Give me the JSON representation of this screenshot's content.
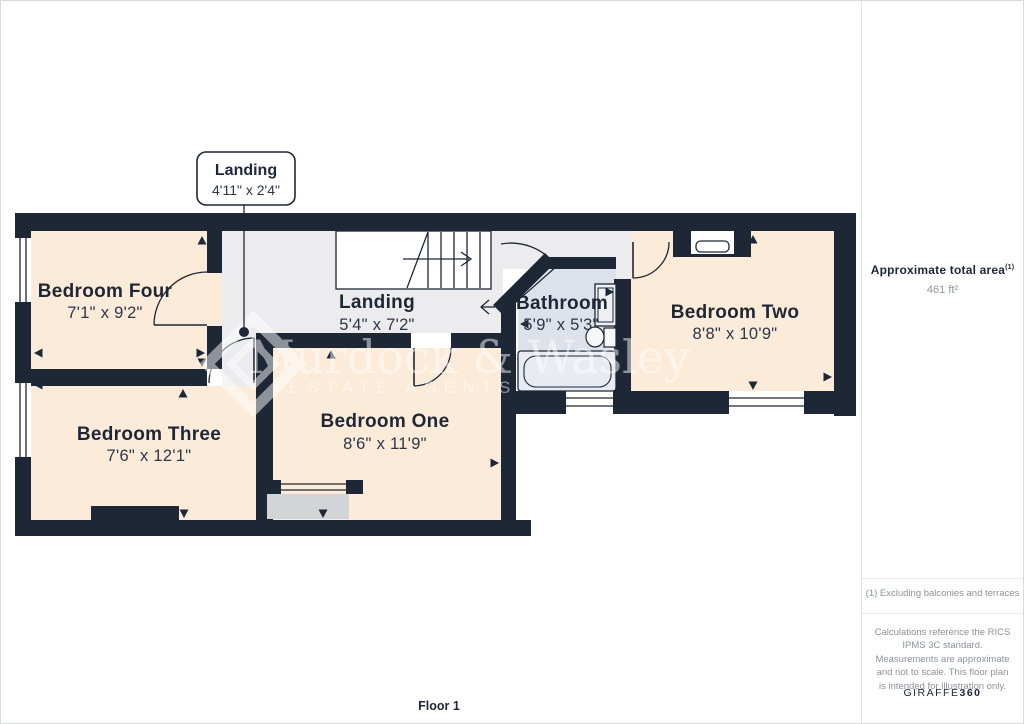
{
  "floorplan": {
    "floor_label": "Floor 1",
    "watermark": {
      "line1": "Murdock & Wasley",
      "line2": "ESTATE AGENTS"
    },
    "callout": {
      "room": "Landing",
      "dims": "4'11\" x 2'4\""
    },
    "rooms": [
      {
        "id": "bedroom-four",
        "name": "Bedroom Four",
        "dims": "7'1\" x 9'2\""
      },
      {
        "id": "landing",
        "name": "Landing",
        "dims": "5'4\" x 7'2\""
      },
      {
        "id": "bathroom",
        "name": "Bathroom",
        "dims": "5'9\" x 5'3\""
      },
      {
        "id": "bedroom-two",
        "name": "Bedroom Two",
        "dims": "8'8\" x 10'9\""
      },
      {
        "id": "bedroom-three",
        "name": "Bedroom Three",
        "dims": "7'6\" x 12'1\""
      },
      {
        "id": "bedroom-one",
        "name": "Bedroom One",
        "dims": "8'6\" x 11'9\""
      }
    ],
    "colors": {
      "wall": "#1d2736",
      "bedroom_fill": "#fcebd9",
      "landing_fill": "#ececee",
      "bathroom_fill": "#dde1ea",
      "hearth_fill": "#d2d4d7",
      "watermark": "#ffffff"
    }
  },
  "sidebar": {
    "area_title": "Approximate total area",
    "area_superscript": "(1)",
    "area_value": "461 ft²",
    "footnote": "(1) Excluding balconies and terraces",
    "disclaimer": "Calculations reference the RICS IPMS 3C standard. Measurements are approximate and not to scale. This floor plan is intended for illustration only.",
    "brand": "GIRAFFE",
    "brand_suffix": "360"
  }
}
